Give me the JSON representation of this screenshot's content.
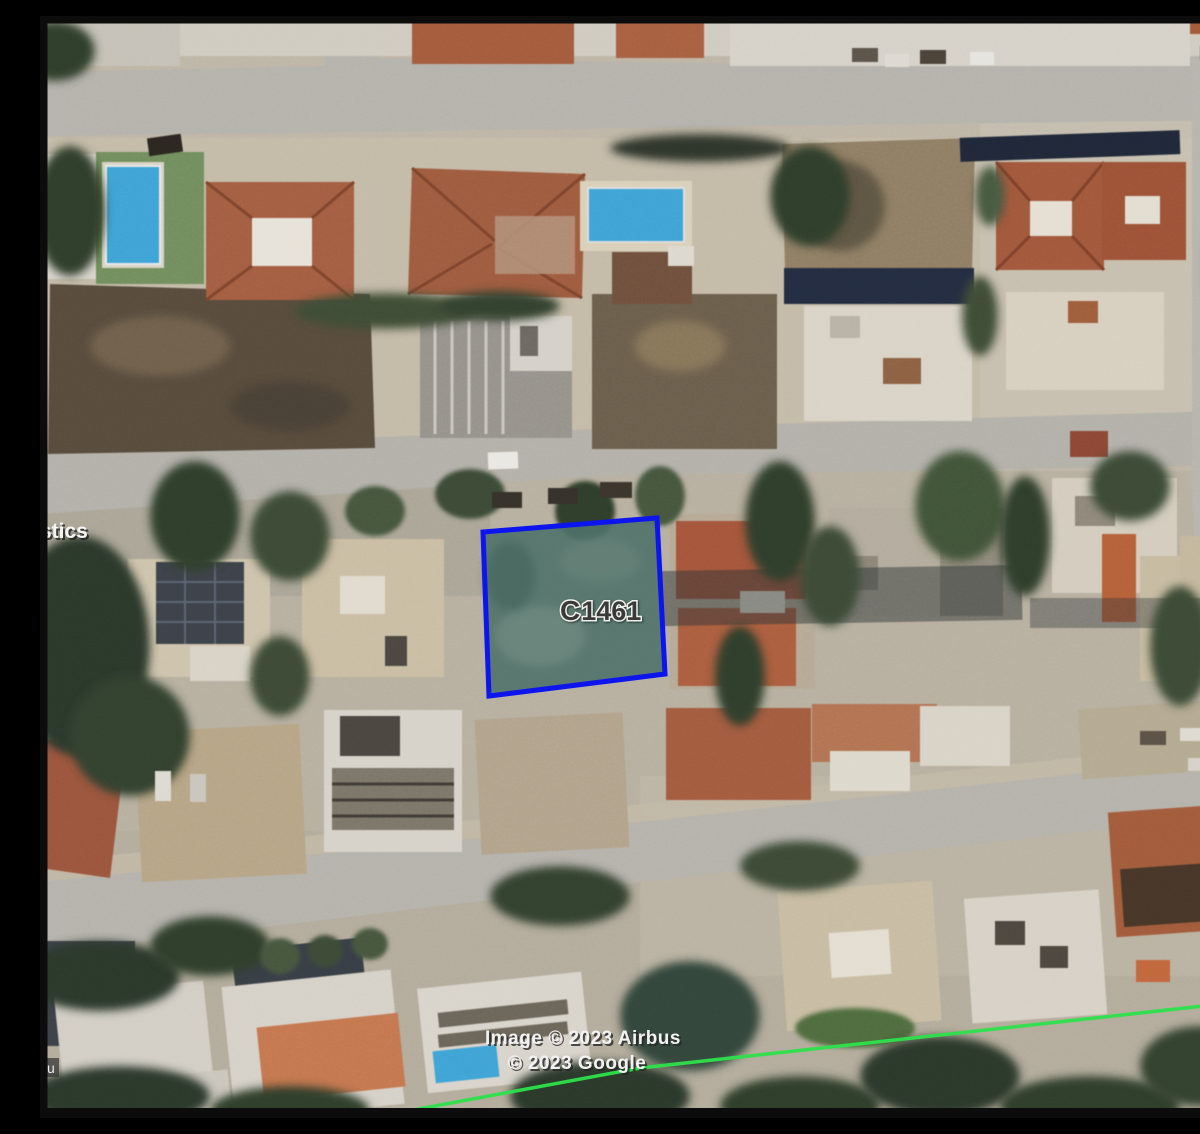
{
  "map": {
    "type": "satellite-imagery",
    "parcel": {
      "label_prefix": "C",
      "label_number": "1461",
      "outline_color": "#0d15ee",
      "fill_color": "#50726a"
    },
    "attribution": {
      "line1": "Image © 2023 Airbus",
      "line2": "© 2023 Google"
    },
    "edge_labels": {
      "left_partial": "stics",
      "bottom_left_partial": "u"
    },
    "boundary_line_color": "#2de24b"
  },
  "palette": {
    "road": "#b3b0aa",
    "ground": "#bdb4a4",
    "field_brown": "#564a3b",
    "dirt_tan": "#b5a384",
    "roof_red": "#a25c40",
    "roof_gray": "#95908a",
    "building_white": "#d8d3c9",
    "vegetation_dark": "#2f3c2c",
    "pool_blue": "#3ea2d4",
    "frame_black": "#0c0c0c"
  }
}
